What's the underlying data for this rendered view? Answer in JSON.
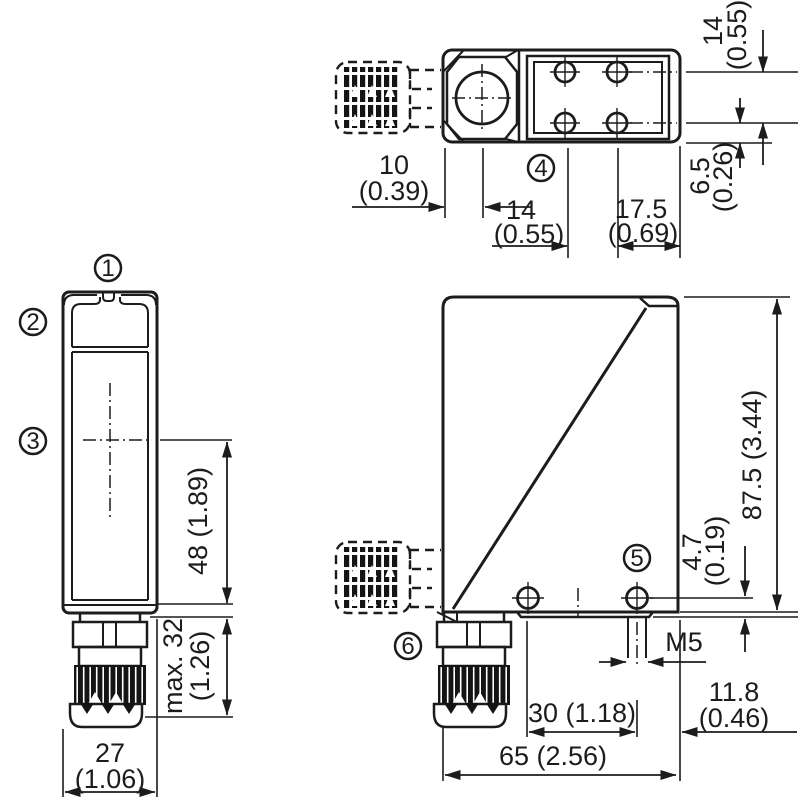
{
  "drawing": {
    "callouts": [
      "1",
      "2",
      "3",
      "4",
      "5",
      "6"
    ],
    "top_view": {
      "width_mm": "14",
      "width_in": "(0.55)",
      "edge_mm": "6.5",
      "edge_in": "(0.26)",
      "front_mm": "10",
      "front_in": "(0.39)",
      "hole_mm": "14",
      "hole_in": "(0.55)",
      "rear_mm": "17.5",
      "rear_in": "(0.69)"
    },
    "front_view": {
      "height": "48 (1.89)",
      "gland_mm": "max. 32",
      "gland_in": "(1.26)",
      "width_mm": "27",
      "width_in": "(1.06)"
    },
    "side_view": {
      "height": "87.5 (3.44)",
      "hole_offset_mm": "4.7",
      "hole_offset_in": "(0.19)",
      "thread": "M5",
      "hole_spacing": "30 (1.18)",
      "rear_mm": "11.8",
      "rear_in": "(0.46)",
      "depth": "65 (2.56)"
    }
  }
}
